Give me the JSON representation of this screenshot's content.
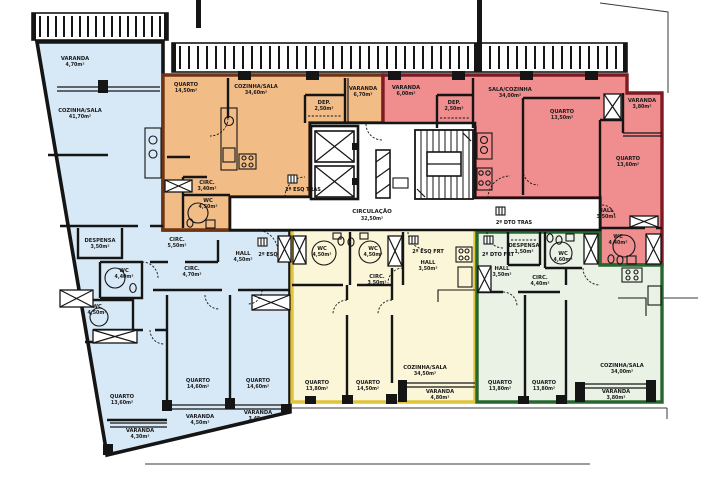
{
  "drawing_title": "Planta do 2º piso — apartamentos",
  "palette": {
    "background": "#ffffff",
    "wall": "#151515",
    "unit_blue_fill": "#d7e9f6",
    "unit_orange_fill": "#f2bc87",
    "unit_orange_border": "#6f3413",
    "unit_red_fill": "#ef8d8f",
    "unit_red_border": "#7e1a24",
    "unit_yellow_fill": "#fcf6d8",
    "unit_yellow_border": "#e0c43c",
    "unit_green_fill": "#eaf2e6",
    "unit_green_border": "#27662f"
  },
  "common": {
    "circulation": {
      "name": "CIRCULAÇÃO",
      "area": "32,50m²"
    }
  },
  "units": {
    "blue": {
      "entry_label": "2º ESQ",
      "rooms": [
        {
          "name": "VARANDA",
          "area": "4,70m²"
        },
        {
          "name": "COZINHA/SALA",
          "area": "41,70m²"
        },
        {
          "name": "DESPENSA",
          "area": "3,50m²"
        },
        {
          "name": "CIRC.",
          "area": "5,50m²"
        },
        {
          "name": "WC",
          "area": "4,40m²"
        },
        {
          "name": "WC",
          "area": "4,50m²"
        },
        {
          "name": "CIRC.",
          "area": "4,70m²"
        },
        {
          "name": "HALL",
          "area": "4,50m²"
        },
        {
          "name": "QUARTO",
          "area": "13,60m²"
        },
        {
          "name": "QUARTO",
          "area": "14,60m²"
        },
        {
          "name": "QUARTO",
          "area": "14,60m²"
        },
        {
          "name": "VARANDA",
          "area": "4,30m²"
        },
        {
          "name": "VARANDA",
          "area": "4,50m²"
        },
        {
          "name": "VARANDA",
          "area": "3,45m²"
        }
      ]
    },
    "orange": {
      "entry_label": "2º ESQ TRAS",
      "rooms": [
        {
          "name": "QUARTO",
          "area": "14,50m²"
        },
        {
          "name": "COZINHA/SALA",
          "area": "34,60m²"
        },
        {
          "name": "DEP.",
          "area": "2,50m²"
        },
        {
          "name": "VARANDA",
          "area": "6,70m²"
        },
        {
          "name": "CIRC.",
          "area": "3,40m²"
        },
        {
          "name": "WC",
          "area": "4,50m²"
        }
      ]
    },
    "red": {
      "entry_label": "2º DTO TRAS",
      "rooms": [
        {
          "name": "VARANDA",
          "area": "6,00m²"
        },
        {
          "name": "DEP.",
          "area": "2,50m²"
        },
        {
          "name": "SALA/COZINHA",
          "area": "34,00m²"
        },
        {
          "name": "QUARTO",
          "area": "13,50m²"
        },
        {
          "name": "QUARTO",
          "area": "13,60m²"
        },
        {
          "name": "VARANDA",
          "area": "3,80m²"
        },
        {
          "name": "HALL",
          "area": "3,50m²"
        },
        {
          "name": "WC",
          "area": "4,40m²"
        }
      ]
    },
    "yellow": {
      "entry_label": "2º ESQ FRT",
      "rooms": [
        {
          "name": "WC",
          "area": "4,50m²"
        },
        {
          "name": "WC",
          "area": "4,50m²"
        },
        {
          "name": "HALL",
          "area": "3,50m²"
        },
        {
          "name": "CIRC.",
          "area": "3,50m²"
        },
        {
          "name": "QUARTO",
          "area": "13,80m²"
        },
        {
          "name": "QUARTO",
          "area": "14,50m²"
        },
        {
          "name": "COZINHA/SALA",
          "area": "34,50m²"
        },
        {
          "name": "VARANDA",
          "area": "4,80m²"
        }
      ]
    },
    "green": {
      "entry_label": "2º DTO FRT",
      "rooms": [
        {
          "name": "DESPENSA",
          "area": "1,50m²"
        },
        {
          "name": "WC",
          "area": "4,60m²"
        },
        {
          "name": "HALL",
          "area": "3,50m²"
        },
        {
          "name": "CIRC.",
          "area": "4,40m²"
        },
        {
          "name": "QUARTO",
          "area": "13,80m²"
        },
        {
          "name": "QUARTO",
          "area": "13,80m²"
        },
        {
          "name": "COZINHA/SALA",
          "area": "34,00m²"
        },
        {
          "name": "VARANDA",
          "area": "3,80m²"
        }
      ]
    }
  }
}
